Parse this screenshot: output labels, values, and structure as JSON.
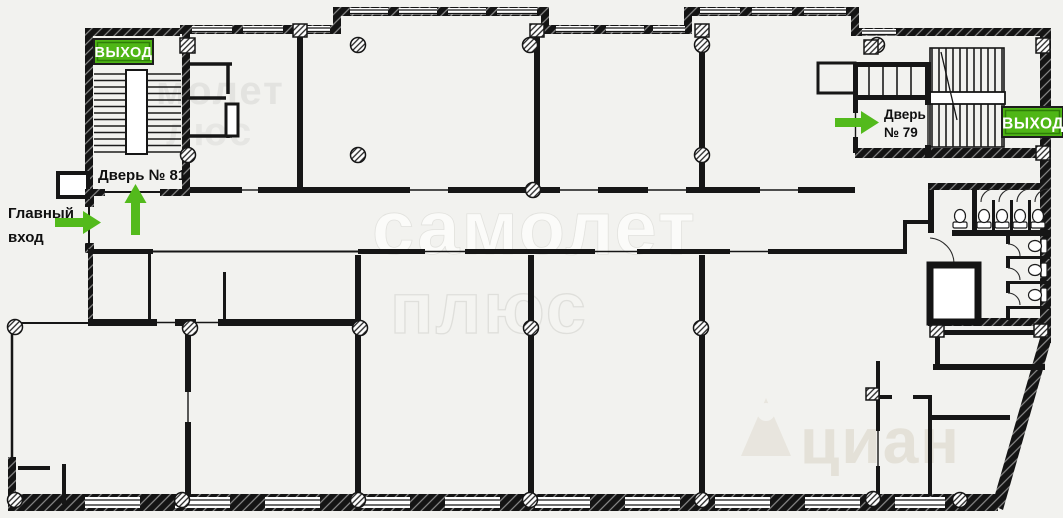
{
  "colors": {
    "background": "#f2f2ef",
    "walls": "#161616",
    "accent_green": "#4fb616",
    "sign_border": "#1d1d1d",
    "sign_inner_border": "#2e7d08",
    "label_text": "#101010"
  },
  "labels": {
    "exit_left": "ВЫХОД",
    "exit_right": "ВЫХОД",
    "door_81": "Дверь № 81",
    "door_79_line1": "Дверь",
    "door_79_line2": "№ 79",
    "main_entrance_line1": "Главный",
    "main_entrance_line2": "вход"
  },
  "watermarks": {
    "brand_fragment_line1": "молет",
    "brand_fragment_line2": "люс",
    "brand_center_line1": "самолет",
    "brand_center_line2": "плюс",
    "brand_bottom_right": "циан"
  }
}
